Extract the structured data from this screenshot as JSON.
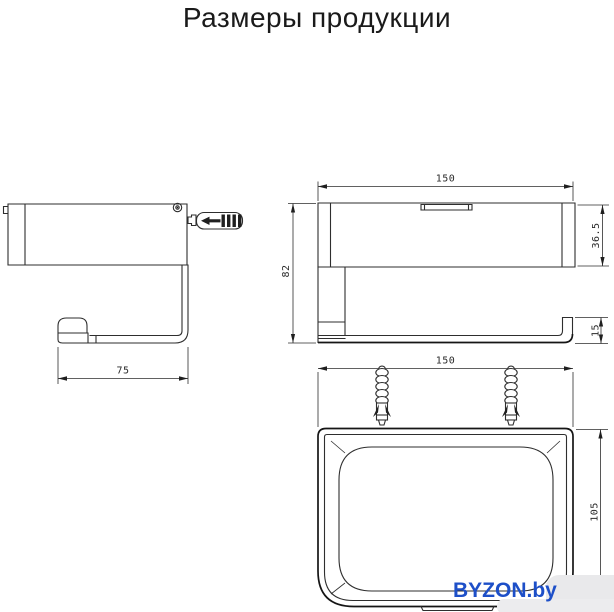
{
  "title": "Размеры продукции",
  "watermark": {
    "text": "BYZON.by",
    "text_color": "#1d4fc8",
    "blob_color": "#e9e9eb"
  },
  "colors": {
    "background": "#ffffff",
    "line": "#2e2e2e",
    "bold_line": "#151515",
    "dim_text": "#2a2a2a",
    "title_text": "#1a1a1a"
  },
  "drawing": {
    "views": {
      "side": {
        "name": "side-view",
        "dimensions": {
          "arm_length": "75"
        }
      },
      "front": {
        "name": "front-view",
        "dimensions": {
          "width": "150",
          "height": "82",
          "body_height": "36.5",
          "arm_height": "15"
        }
      },
      "top": {
        "name": "top-view",
        "dimensions": {
          "width": "150",
          "depth": "105"
        }
      }
    },
    "icons": [
      "screw-head-icon",
      "wall-anchor-horizontal-icon",
      "wall-anchor-vertical-icon"
    ]
  }
}
